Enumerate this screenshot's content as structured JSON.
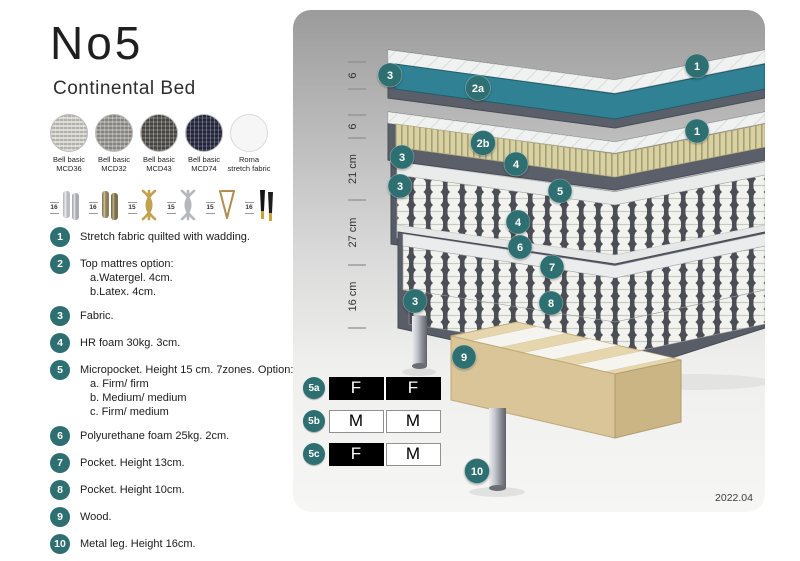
{
  "colors": {
    "accent": "#2e6f71",
    "watergel": "#2f8193",
    "latex_rib": "#d8d1a3",
    "fabric_dark": "#5a5f6a",
    "wood": "#e6d6ae"
  },
  "header": {
    "title": "No5",
    "subtitle": "Continental Bed"
  },
  "fabric_swatches": [
    {
      "name": "Bell basic",
      "code": "MCD36",
      "base": "#dcdad4",
      "weave": "#b4b2ab",
      "plain": false
    },
    {
      "name": "Bell basic",
      "code": "MCD32",
      "base": "#a9a7a5",
      "weave": "#86847f",
      "plain": false
    },
    {
      "name": "Bell basic",
      "code": "MCD43",
      "base": "#64635f",
      "weave": "#454440",
      "plain": false
    },
    {
      "name": "Bell basic",
      "code": "MCD74",
      "base": "#3a3d52",
      "weave": "#22253a",
      "plain": false
    },
    {
      "name": "Roma",
      "code": "stretch fabric",
      "base": "#f6f6f6",
      "weave": "#f6f6f6",
      "plain": true
    }
  ],
  "leg_options": [
    {
      "height": "16",
      "type": "cylinder-silver"
    },
    {
      "height": "16",
      "type": "cylinder-bronze"
    },
    {
      "height": "15",
      "type": "twist-gold"
    },
    {
      "height": "15",
      "type": "twist-silver"
    },
    {
      "height": "15",
      "type": "hairpin-gold"
    },
    {
      "height": "16",
      "type": "black-gold"
    }
  ],
  "legend": {
    "items": [
      {
        "num": "1",
        "text": "Stretch fabric quilted with wadding.",
        "sub": []
      },
      {
        "num": "2",
        "text": "Top mattres option:",
        "sub": [
          "a.Watergel. 4cm.",
          "b.Latex. 4cm."
        ]
      },
      {
        "num": "3",
        "text": "Fabric.",
        "sub": []
      },
      {
        "num": "4",
        "text": "HR foam 30kg. 3cm.",
        "sub": []
      },
      {
        "num": "5",
        "text": "Micropocket. Height 15 cm. 7zones. Option:",
        "sub": [
          "a. Firm/ firm",
          "b. Medium/ medium",
          "c. Firm/ medium"
        ]
      },
      {
        "num": "6",
        "text": "Polyurethane foam 25kg. 2cm.",
        "sub": []
      },
      {
        "num": "7",
        "text": "Pocket. Height 13cm.",
        "sub": []
      },
      {
        "num": "8",
        "text": "Pocket. Height 10cm.",
        "sub": []
      },
      {
        "num": "9",
        "text": "Wood.",
        "sub": []
      },
      {
        "num": "10",
        "text": "Metal leg. Height 16cm.",
        "sub": []
      }
    ]
  },
  "diagram": {
    "ruler": [
      "6",
      "6",
      "21 cm",
      "27 cm",
      "16 cm"
    ],
    "markers": [
      "3",
      "2a",
      "1",
      "3",
      "2b",
      "1",
      "3",
      "4",
      "5",
      "4",
      "6",
      "7",
      "8",
      "3",
      "9",
      "10"
    ],
    "firmness_rows": [
      {
        "label": "5a",
        "cells": [
          {
            "text": "F",
            "variant": "filled"
          },
          {
            "text": "F",
            "variant": "filled"
          }
        ]
      },
      {
        "label": "5b",
        "cells": [
          {
            "text": "M",
            "variant": "outline"
          },
          {
            "text": "M",
            "variant": "outline"
          }
        ]
      },
      {
        "label": "5c",
        "cells": [
          {
            "text": "F",
            "variant": "filled"
          },
          {
            "text": "M",
            "variant": "outline"
          }
        ]
      }
    ],
    "version": "2022.04"
  }
}
